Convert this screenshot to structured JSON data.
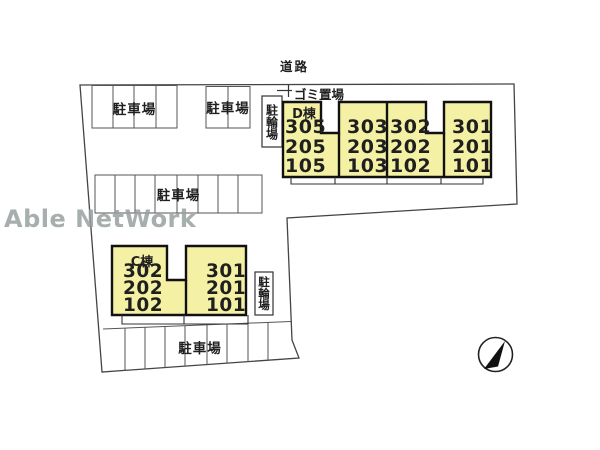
{
  "watermark": "Able NetWork",
  "labels": {
    "road": "道路",
    "garbage_area": "ゴミ置場",
    "parking": "駐車場",
    "bicycle_parking": "駐輪場"
  },
  "buildings": {
    "d": {
      "name": "D棟",
      "sections": [
        {
          "rooms": [
            "305",
            "205",
            "105"
          ]
        },
        {
          "rooms": [
            "303",
            "203",
            "103"
          ]
        },
        {
          "rooms": [
            "302",
            "202",
            "102"
          ]
        },
        {
          "rooms": [
            "301",
            "201",
            "101"
          ]
        }
      ]
    },
    "c": {
      "name": "C棟",
      "sections": [
        {
          "rooms": [
            "302",
            "202",
            "102"
          ]
        },
        {
          "rooms": [
            "301",
            "201",
            "101"
          ]
        }
      ]
    }
  },
  "colors": {
    "building_fill": "#F5F1A4",
    "line": "#333333",
    "building_outline": "#111111",
    "watermark": "#98A0A0"
  },
  "compass": {
    "icon": "north-arrow"
  }
}
